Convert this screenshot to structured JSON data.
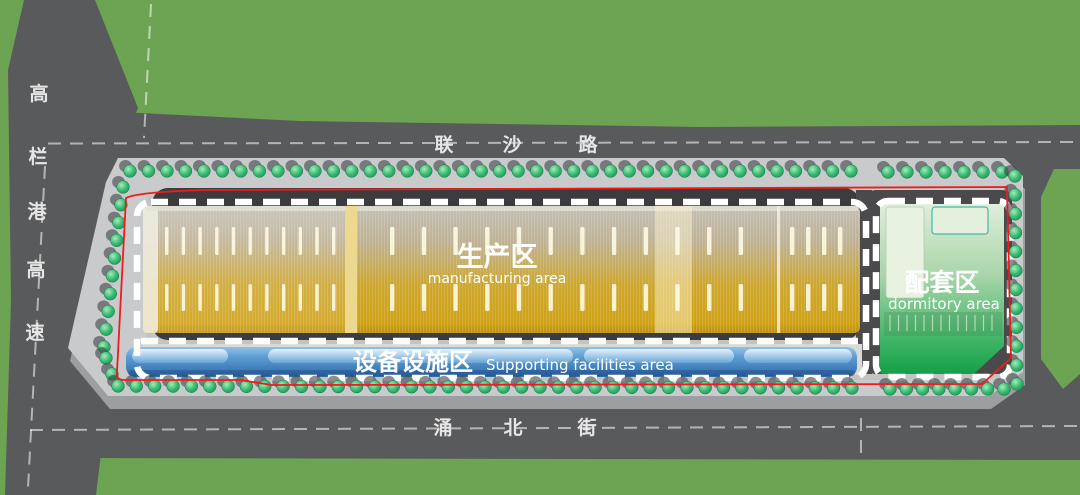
{
  "roads": {
    "top": {
      "name": "联沙路",
      "chars": [
        "联",
        "沙",
        "路"
      ]
    },
    "bottom": {
      "name": "涌北街",
      "chars": [
        "涌",
        "北",
        "街"
      ]
    },
    "left": {
      "name": "高栏港高速",
      "chars": [
        "高",
        "栏",
        "港",
        "高",
        "速"
      ]
    }
  },
  "zones": {
    "manufacturing": {
      "zh": "生产区",
      "en": "manufacturing area",
      "color": "#d0a41c"
    },
    "supporting": {
      "zh": "设备设施区",
      "en": "Supporting facilities area",
      "color": "#4e94cb"
    },
    "dormitory": {
      "zh": "配套区",
      "en": "dormitory area",
      "color": "#1ca44b"
    }
  },
  "boundary": {
    "site_outline_color": "#ee1c1c",
    "parcel_dash_color": "#ffffff"
  }
}
